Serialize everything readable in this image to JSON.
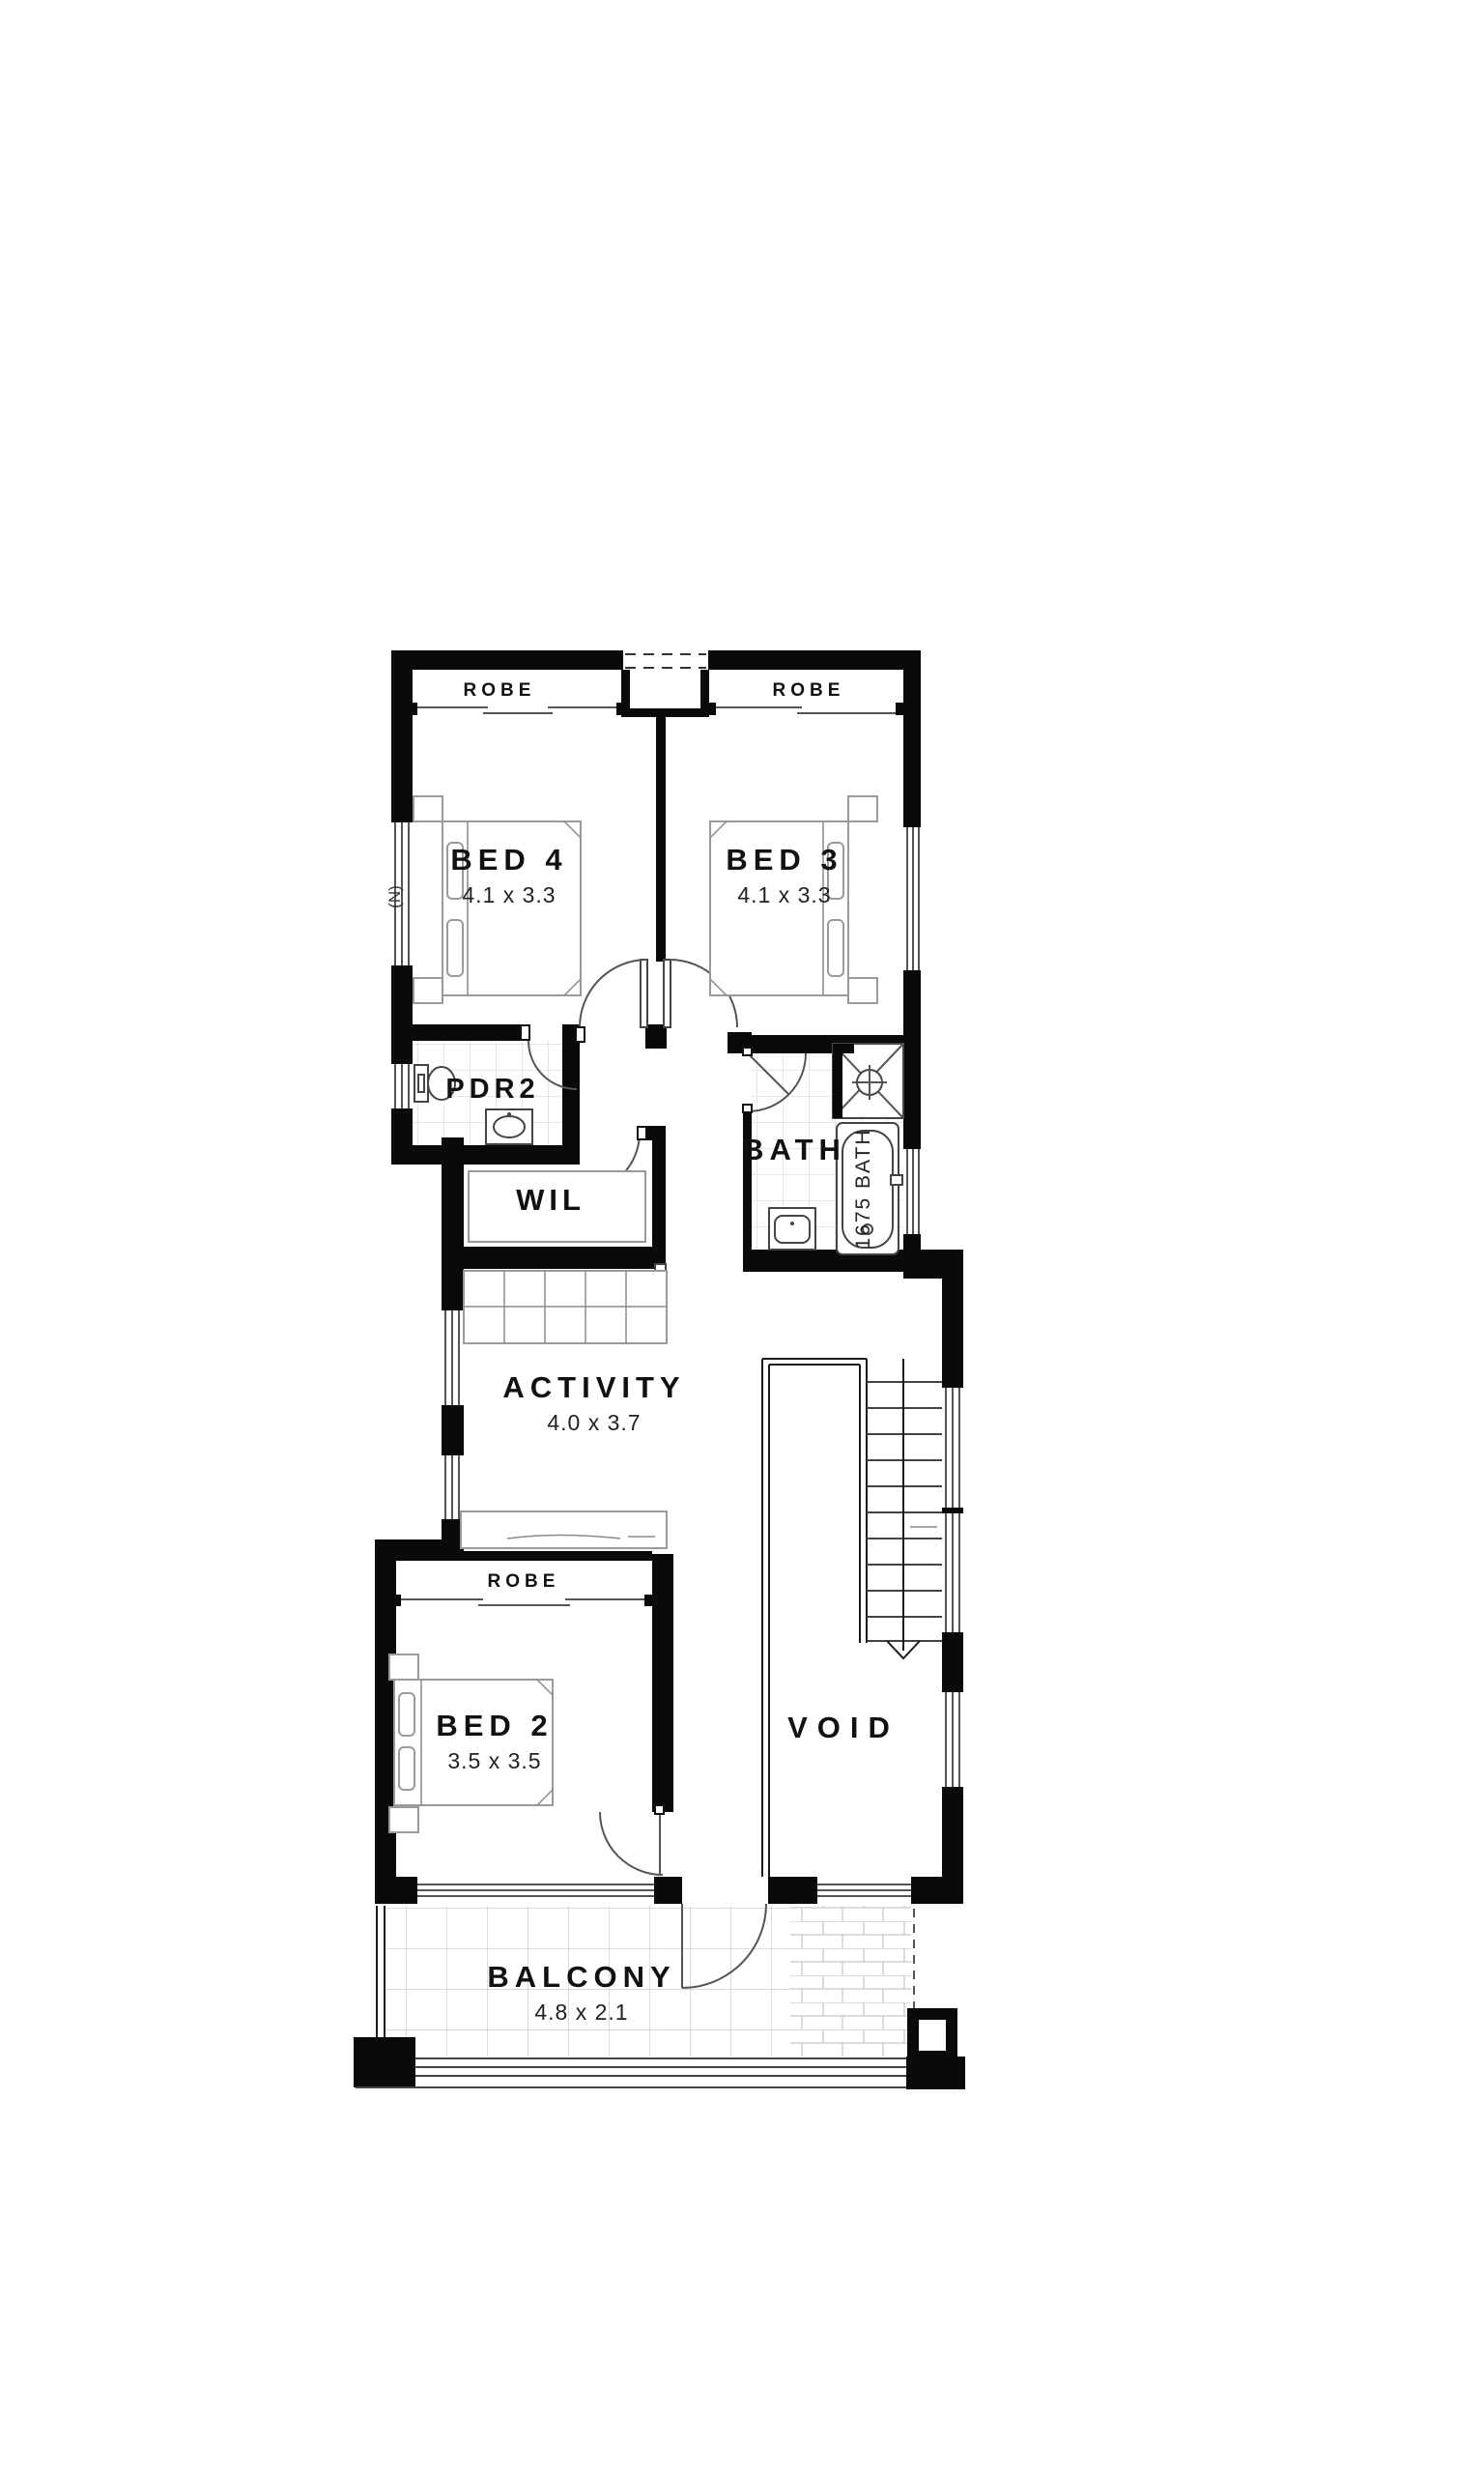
{
  "plan": {
    "rooms": {
      "bed4": {
        "label": "BED 4",
        "dims": "4.1 x 3.3"
      },
      "bed3": {
        "label": "BED 3",
        "dims": "4.1 x 3.3"
      },
      "bed2": {
        "label": "BED 2",
        "dims": "3.5 x 3.5"
      },
      "activity": {
        "label": "ACTIVITY",
        "dims": "4.0 x 3.7"
      },
      "balcony": {
        "label": "BALCONY",
        "dims": "4.8 x 2.1"
      },
      "pdr2": {
        "label": "PDR2"
      },
      "wil": {
        "label": "WIL"
      },
      "bath": {
        "label": "BATH"
      },
      "void": {
        "label": "VOID"
      }
    },
    "labels": {
      "robe_bed4": "ROBE",
      "robe_bed3": "ROBE",
      "robe_bed2": "ROBE",
      "bath_tub": "1675 BATH",
      "north_marker": "(N)"
    },
    "colors": {
      "wall": "#0a0a0a",
      "background": "#ffffff",
      "line": "#555555",
      "tile": "#d5d5d5",
      "text": "#111111"
    }
  }
}
